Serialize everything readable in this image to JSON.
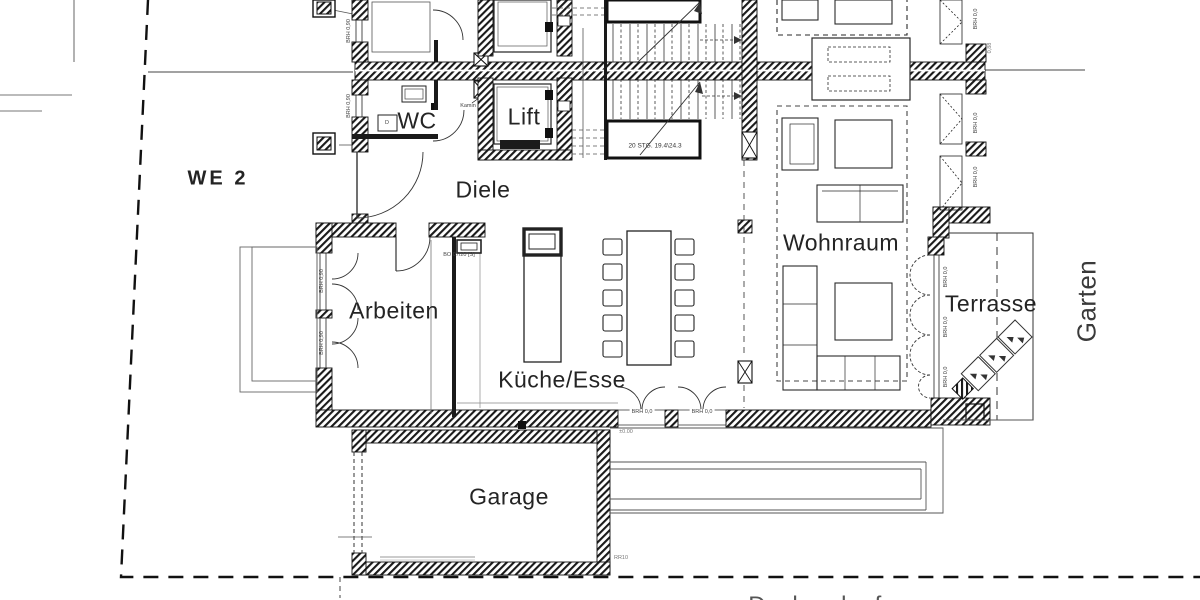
{
  "plan": {
    "labels": {
      "unit": "WE 2",
      "wc": "WC",
      "lift": "Lift",
      "diele": "Diele",
      "arbeiten": "Arbeiten",
      "kueche_esse": "Küche/Esse",
      "wohnraum": "Wohnraum",
      "terrasse": "Terrasse",
      "garage": "Garage",
      "garten": "Garten"
    },
    "annotations": {
      "stair_note": "20 STG. 19.4\\24.3",
      "kamin": "Kamin",
      "door_note": "BO 07/20 [S]",
      "brh_00": "BRH 0,0",
      "brh_090": "BRH 0,90",
      "level": "±0.00",
      "drain": "RR10",
      "sill": "0,88",
      "washer": "D",
      "clipped_text": "Dachverlauf"
    },
    "colors": {
      "line": "#1a1a1a",
      "wall": "#151515",
      "bg": "#ffffff"
    }
  }
}
